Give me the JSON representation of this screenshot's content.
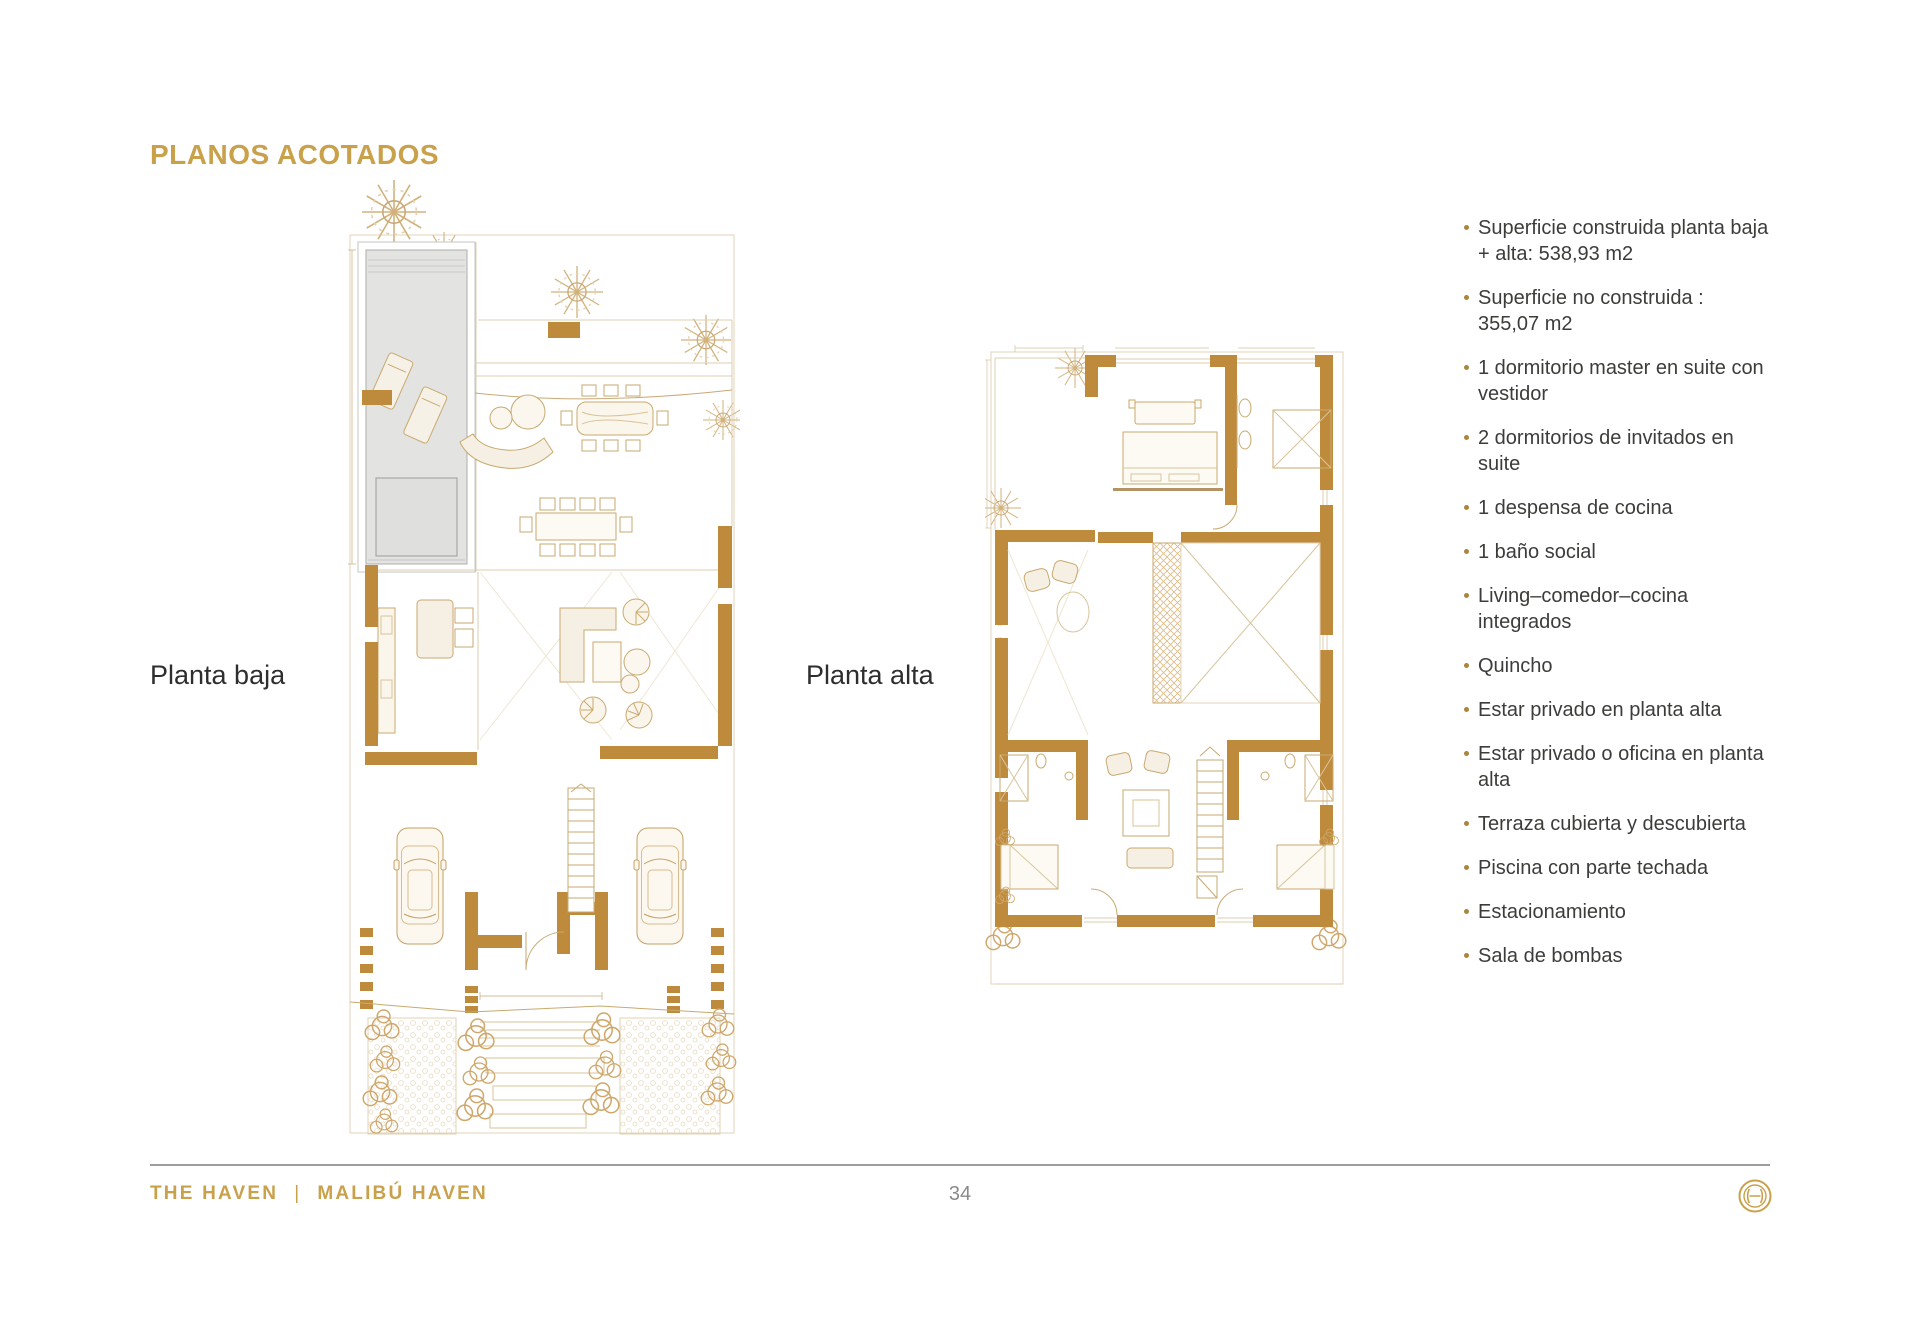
{
  "page": {
    "title": "PLANOS ACOTADOS",
    "page_number": "34"
  },
  "plans": [
    {
      "label": "Planta baja"
    },
    {
      "label": "Planta alta"
    }
  ],
  "features": {
    "items": [
      "Superficie construida planta baja + alta: 538,93 m2",
      "Superficie no construida : 355,07 m2",
      "1 dormitorio master en suite con vestidor",
      "2 dormitorios de invitados en suite",
      "1 despensa de cocina",
      "1 baño social",
      "Living–comedor–cocina integrados",
      "Quincho",
      "Estar privado en planta alta",
      "Estar privado o oficina en planta alta",
      "Terraza cubierta y descubierta",
      "Piscina con parte techada",
      "Estacionamiento",
      "Sala de bombas"
    ]
  },
  "footer": {
    "brand": "THE HAVEN",
    "separator": "|",
    "project": "MALIBÚ HAVEN",
    "logo_icon": "haven-monogram"
  },
  "colors": {
    "accent_gold": "#C9A14B",
    "wall_gold": "#BE8B3D",
    "drawing_tan": "#C9A96F",
    "pool_gray": "#E3E3E2",
    "text_dark": "#3C3C39",
    "muted_gray": "#8A8A8A",
    "divider_gray": "#9D9D9D"
  }
}
